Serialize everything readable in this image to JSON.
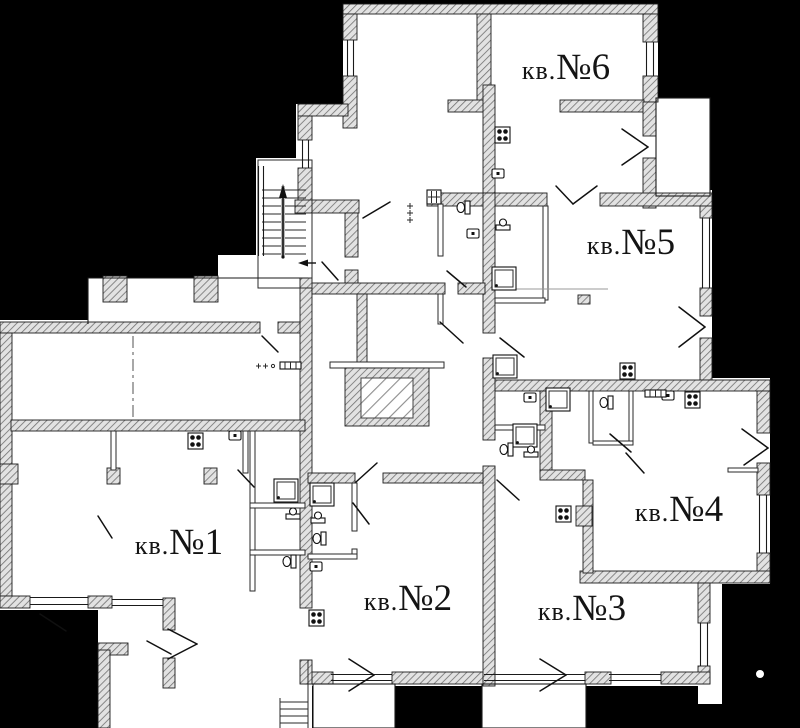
{
  "title": "apartment-floor-plan",
  "colors": {
    "background": "#000000",
    "paper": "#ffffff",
    "wall_hatch_fill": "#e2e2e2",
    "wall_hatch_line": "#707070",
    "ink": "#141414"
  },
  "apartments": [
    {
      "id": 1,
      "prefix": "кв.",
      "number": "№1",
      "full": "кв.№1"
    },
    {
      "id": 2,
      "prefix": "кв.",
      "number": "№2",
      "full": "кв.№2"
    },
    {
      "id": 3,
      "prefix": "кв.",
      "number": "№3",
      "full": "кв.№3"
    },
    {
      "id": 4,
      "prefix": "кв.",
      "number": "№4",
      "full": "кв.№4"
    },
    {
      "id": 5,
      "prefix": "кв.",
      "number": "№5",
      "full": "кв.№5"
    },
    {
      "id": 6,
      "prefix": "кв.",
      "number": "№6",
      "full": "кв.№6"
    }
  ]
}
